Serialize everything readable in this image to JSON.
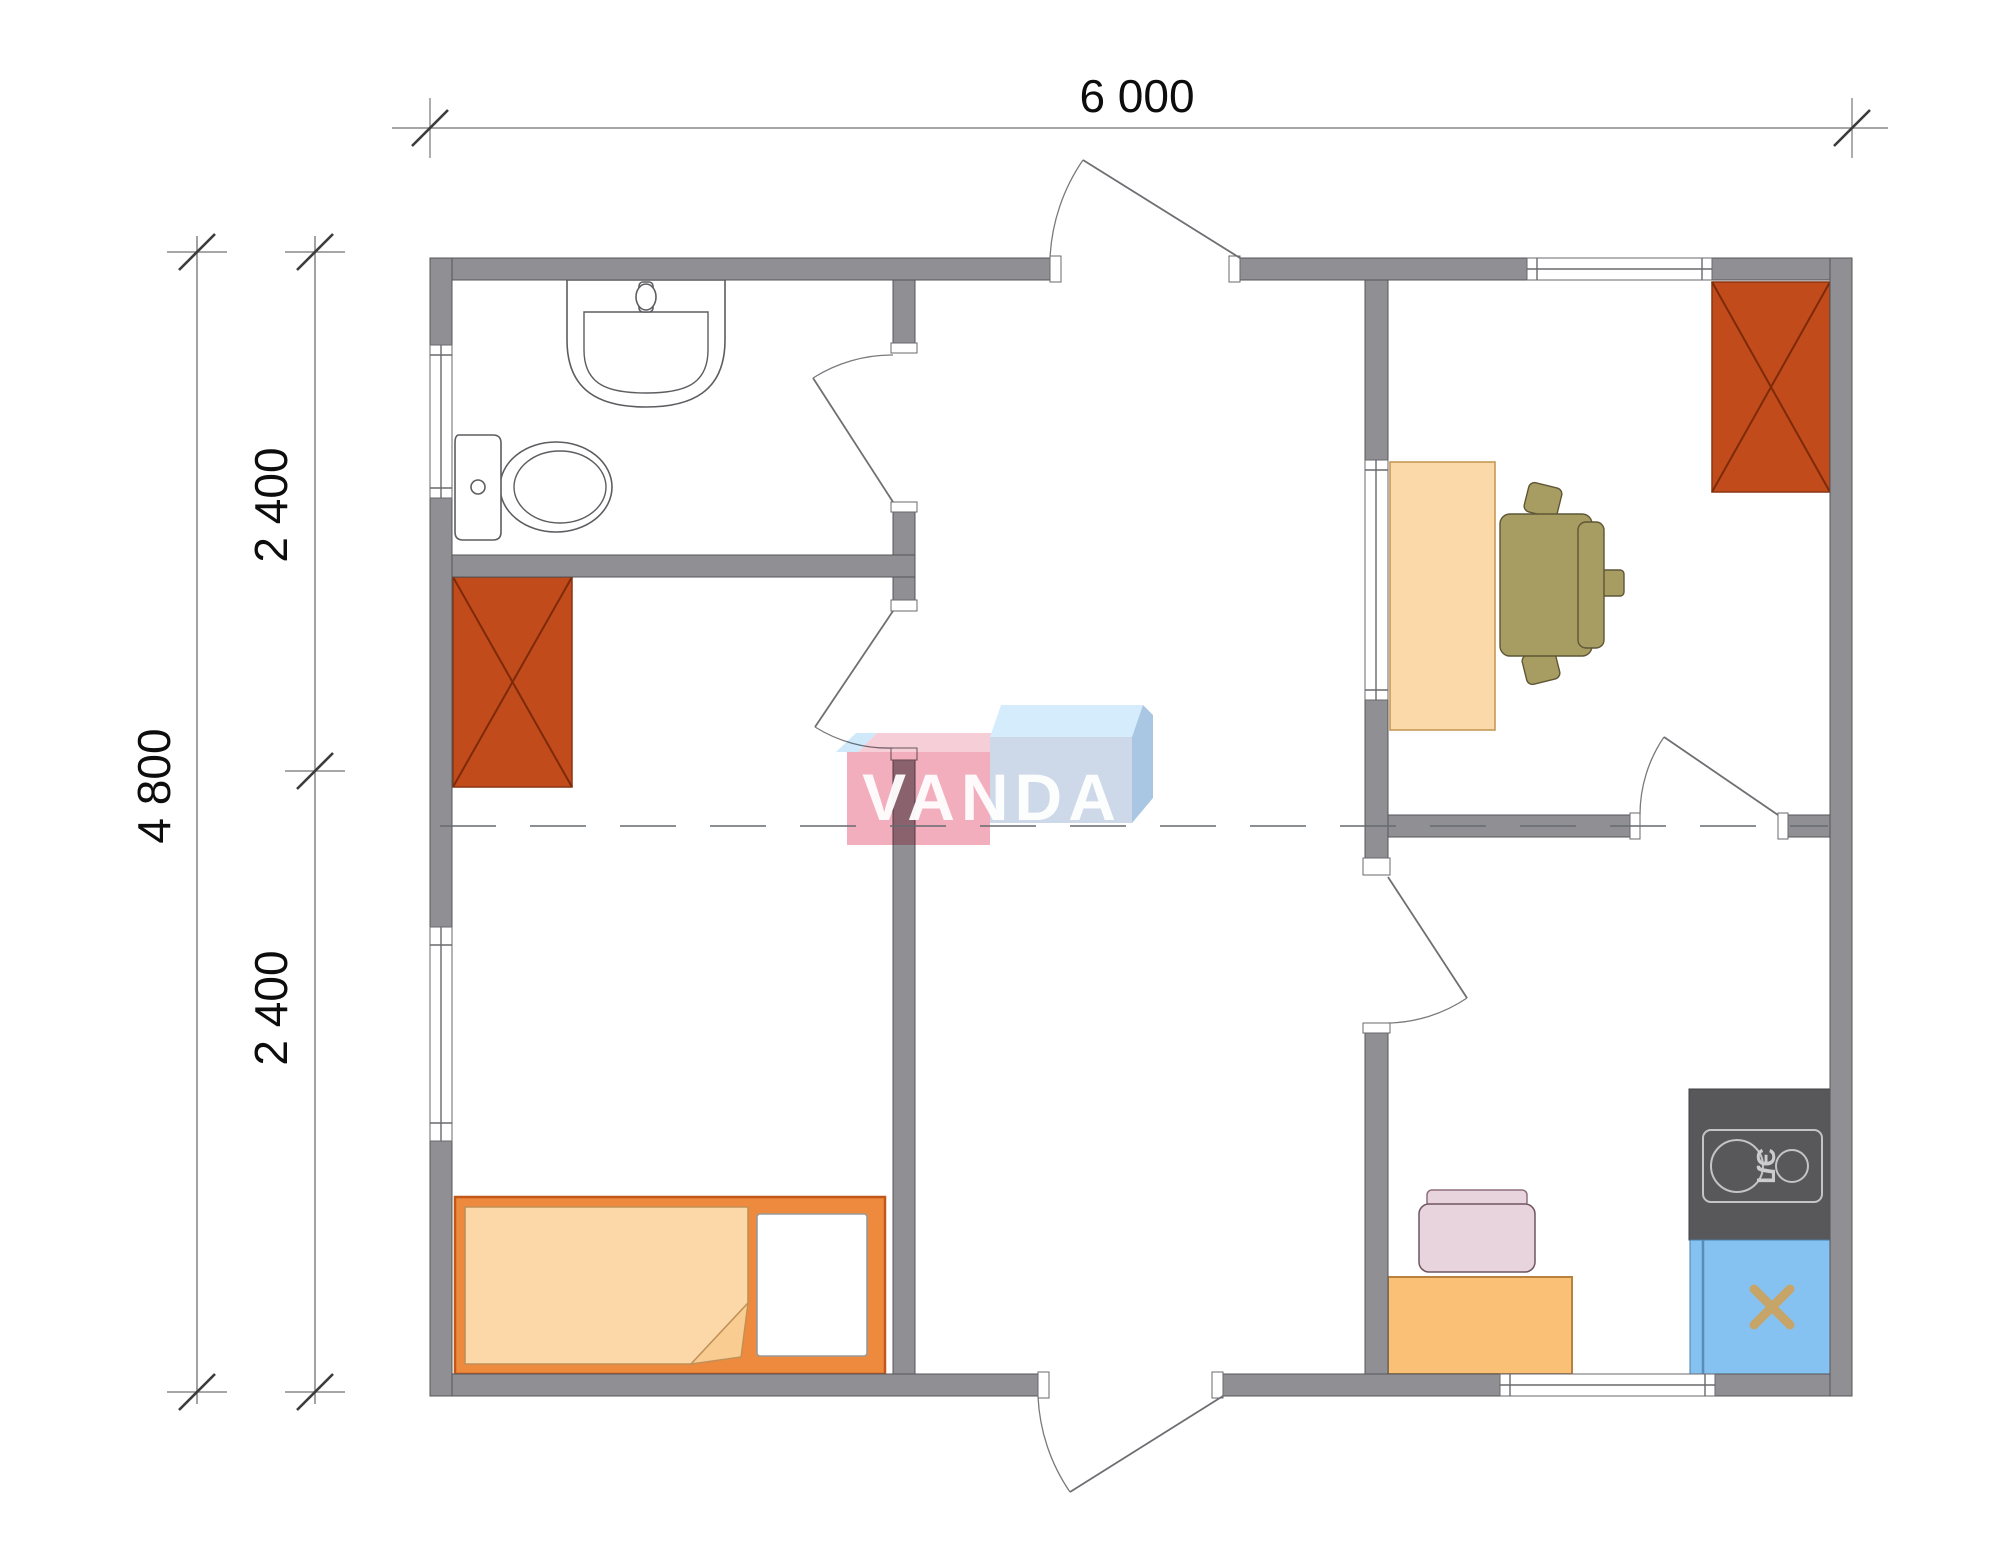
{
  "dimensions": {
    "top_width": "6 000",
    "left_total": "4 800",
    "left_upper": "2 400",
    "left_lower": "2 400"
  },
  "watermark": {
    "text": "VANDA"
  },
  "stove": {
    "label": "ЭЛ"
  },
  "colors": {
    "wall": "#909094",
    "wardrobe": "#c24b1c",
    "wardrobe_line": "#7d2a08",
    "bed_frame": "#ee8a3d",
    "blanket": "#fcd8a8",
    "blanket_flap": "#f9cd92",
    "pillow": "#ffffff",
    "desk": "#fcd9a8",
    "office_chair": "#a79d62",
    "office_chair_line": "#5f5636",
    "kitchen_table": "#f9c076",
    "kitchen_table_line": "#b8813c",
    "kitchen_chair": "#e8d4dc",
    "kitchen_chair_line": "#8f6f7d",
    "stove_body": "#58585a",
    "stove_lines": "#c4c4c4",
    "stove_text": "#cccccc",
    "sink_blue": "#85c2f1",
    "sink_blue_line": "#5a8cba",
    "sink_cross": "#c7a467",
    "wm_light_blue": "#cfe9fa",
    "wm_pink_top": "#f6ced8",
    "wm_pink": "#f2aebc",
    "wm_blue_top": "#d4ecfb",
    "wm_blue_side": "#a9c6e2",
    "wm_blue": "#cdd8e9"
  }
}
